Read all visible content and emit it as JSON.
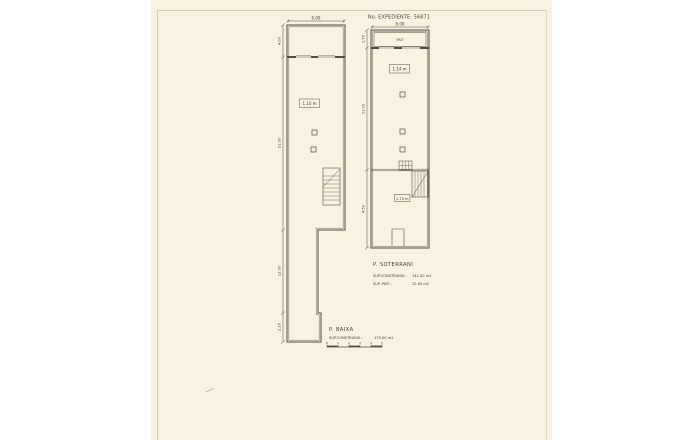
{
  "sheet": {
    "expediente": "No. EXPEDIENTE: 56871",
    "colors": {
      "paper": "#faf2e1",
      "ink": "#4f4b42"
    }
  },
  "plan_baixa": {
    "title": "P. BAIXA",
    "sup_construida_label": "SUP.CONSTRUIDA :",
    "sup_construida_value": "175.00 m2",
    "dim_width": "6.00",
    "dims_left": {
      "top": "4.60",
      "main": "21.00",
      "lower": "12.00",
      "bottom": "2.20"
    },
    "room_label": "1.10 m"
  },
  "plan_soterrani": {
    "title": "P. SOTERRANI",
    "sup_construida_label": "SUP.CONSTRUIDA :",
    "sup_construida_value": "141.00 m2",
    "sup_pati_label": "SUP. PATI :",
    "sup_pati_value": "12.00 m2",
    "dim_width": "6.00",
    "dims_left": {
      "pati": "1.70",
      "main": "11.00",
      "lower": "4.50"
    },
    "pati_label": "PATI",
    "room_label_upper": "1.14 m",
    "room_label_lower": "1.70 m"
  },
  "scale_bar": {
    "ticks": [
      "0",
      "1",
      "2",
      "3",
      "4",
      "5"
    ]
  }
}
